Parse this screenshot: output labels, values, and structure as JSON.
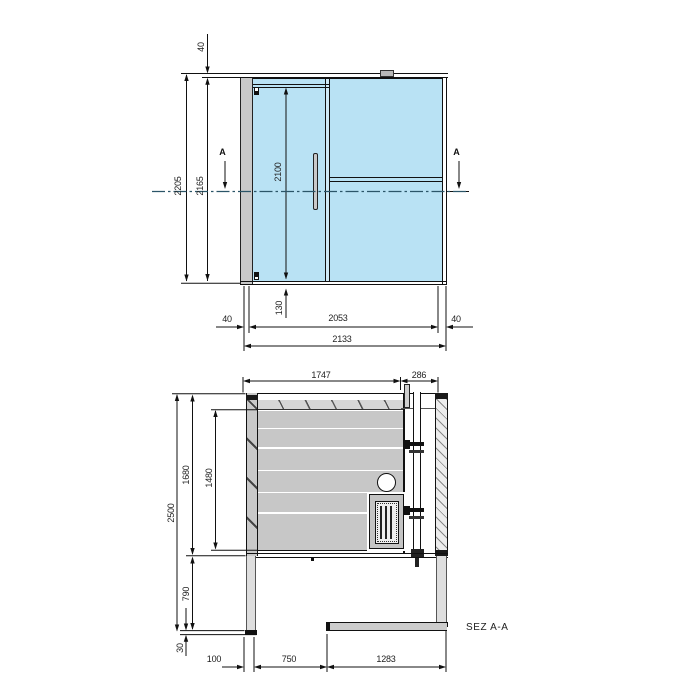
{
  "elevation": {
    "roof_offset": "40",
    "total_height": "2205",
    "clear_height": "2165",
    "door_height": "2100",
    "base_height": "130",
    "left_profile": "40",
    "glass_width": "2053",
    "right_profile": "40",
    "total_width": "2133",
    "section_marker_left": "A",
    "section_marker_right": "A"
  },
  "plan": {
    "back_width": "1747",
    "door_width": "286",
    "total_depth": "2500",
    "cabin_depth": "1680",
    "cabin_inner_depth": "1480",
    "front_depth": "790",
    "base_depth": "30",
    "seg_left": "100",
    "seg_opening": "750",
    "seg_wall": "1283",
    "section_label": "SEZ A-A"
  },
  "colors": {
    "glass": "#b9e2f4",
    "frame_gray": "#c9c9c9",
    "band_gray": "#c7c7c7",
    "light_gray": "#dedede",
    "line": "#1a1a1a",
    "centerline": "#2b5568"
  }
}
